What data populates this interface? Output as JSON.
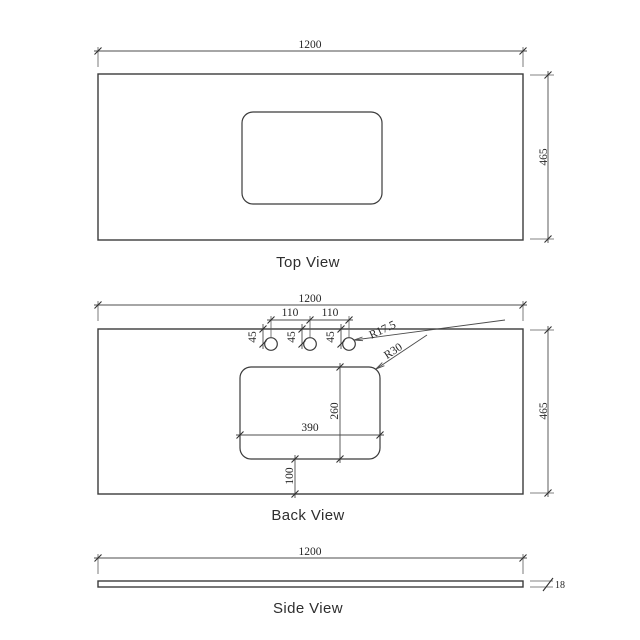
{
  "colors": {
    "ink": "#3b3b3b",
    "dim_text": "#262626",
    "background": "#ffffff"
  },
  "views": {
    "top": {
      "label": "Top View",
      "dims": {
        "width": "1200",
        "depth": "465"
      }
    },
    "back": {
      "label": "Back View",
      "dims": {
        "width": "1200",
        "height": "465",
        "hole_pitch": [
          "110",
          "110"
        ],
        "hole_setback": [
          "45",
          "45",
          "45"
        ],
        "hole_radius": "R17.5",
        "cutout_corner_radius": "R30",
        "cutout_width": "390",
        "cutout_height": "260",
        "cutout_to_bottom": "100"
      }
    },
    "side": {
      "label": "Side View",
      "dims": {
        "width": "1200",
        "thickness": "18"
      }
    }
  }
}
